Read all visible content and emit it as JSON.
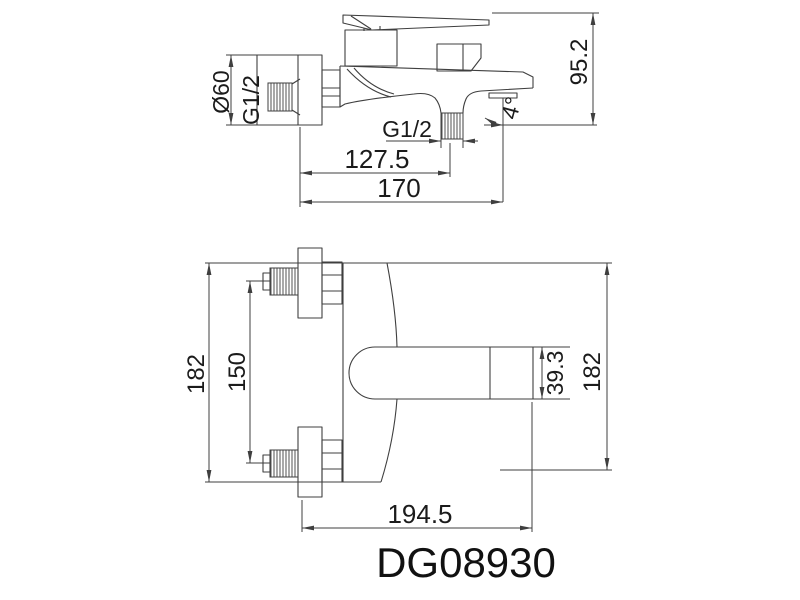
{
  "page": {
    "type": "technical-drawing",
    "background_color": "#ffffff",
    "line_color": "#3f3f3f",
    "text_color": "#1b1b1b"
  },
  "model": {
    "number": "DG08930"
  },
  "side_view": {
    "description": "bath mixer faucet side elevation",
    "labels": {
      "escutcheon_diameter": "Ø60",
      "inlet_thread": "G1/2",
      "outlet_thread": "G1/2",
      "outlet_center_distance": "127.5",
      "spout_length": "170",
      "body_height": "95.2",
      "spout_angle": "4°"
    }
  },
  "front_view": {
    "description": "bath mixer faucet plan view",
    "labels": {
      "overall_height_left": "182",
      "inlet_center_distance": "150",
      "handle_end_width": "39.3",
      "overall_height_right": "182",
      "overall_depth": "194.5"
    }
  }
}
